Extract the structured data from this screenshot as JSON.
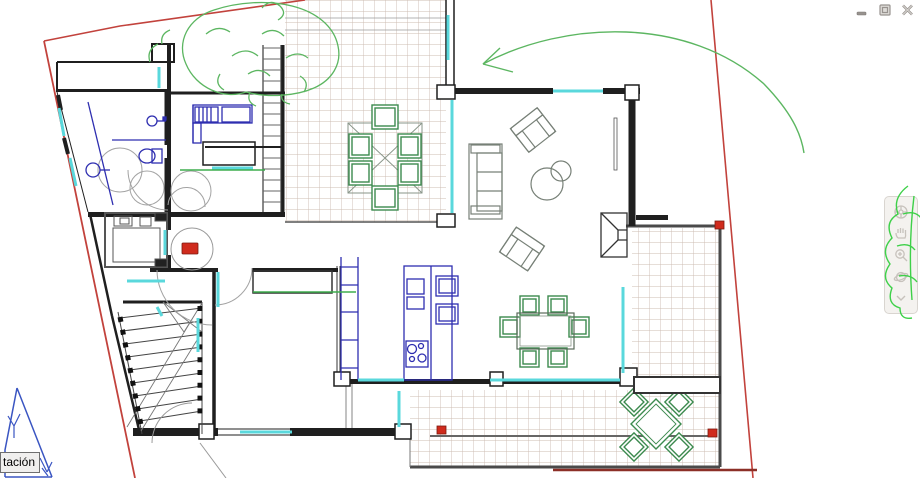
{
  "tooltip": {
    "text": "tación"
  },
  "window_controls": {
    "minimize_icon": "window-minimize-bar",
    "restore_icon": "window-restore-overlapping-squares",
    "close_icon": "window-close-x"
  },
  "navbar": {
    "icons": [
      "steering-wheel-icon",
      "pan-hand-icon",
      "zoom-magnifier-icon",
      "orbit-icon",
      "more-chevron-icon"
    ]
  },
  "colors": {
    "wall": "#1f1f1f",
    "boundary": "#c2423c",
    "boundary_dark": "#8c2f27",
    "marker": "#d02b1d",
    "marker_edge": "#7c1a10",
    "cyan": "#5ad8dc",
    "blue": "#2e2eb0",
    "green": "#3c8a4e",
    "table_gray": "#778077",
    "tree": "#5cb661",
    "tree_bright": "#35cf41",
    "grid": "#ccbcb2",
    "gray": "#a3a3a3",
    "dark_gray": "#555555",
    "navbar": "#f4f2ef",
    "navbar_border": "#d9d5d0",
    "navbar_icon": "#c7c2bc",
    "chrome_icon": "#98938f",
    "tooltip_bg": "#f0efee",
    "tooltip_border": "#6f6f6f",
    "blue_triangle": "#3a55c2",
    "threshold_green": "#3fae4e"
  }
}
